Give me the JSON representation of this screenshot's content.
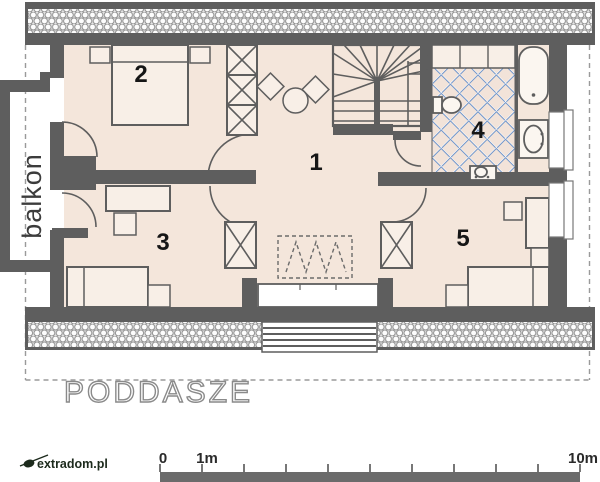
{
  "title": "PODDASZE",
  "watermark": "extradom.pl",
  "balcony_label": "balkon",
  "rooms": {
    "hall": "1",
    "bedroom_top_left": "2",
    "bedroom_bottom_left": "3",
    "bathroom": "4",
    "bedroom_right": "5"
  },
  "scale": {
    "zero": "0",
    "one_meter": "1m",
    "ten_meter": "10m"
  },
  "colors": {
    "wall": "#5e5e5e",
    "floor": "#f4e6db",
    "floor_light": "#f8efe7",
    "furniture_fill": "#f8efe7",
    "tile_line": "#6f94c9",
    "hatch_bg": "#e4e4e4",
    "scale_bar": "#6b6b6b"
  }
}
